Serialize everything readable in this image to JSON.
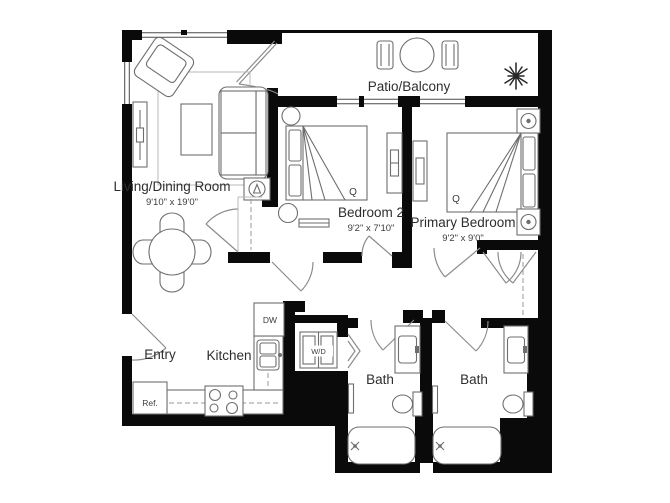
{
  "rooms": {
    "living_dining": {
      "name": "Living/Dining Room",
      "dims": "9'10\" x 19'0\""
    },
    "patio": {
      "name": "Patio/Balcony"
    },
    "bedroom2": {
      "name": "Bedroom 2",
      "dims": "9'2\" x 7'10\"",
      "bed_size": "Q"
    },
    "primary": {
      "name": "Primary Bedroom",
      "dims": "9'2\" x 9'0\"",
      "bed_size": "Q"
    },
    "entry": {
      "name": "Entry"
    },
    "kitchen": {
      "name": "Kitchen"
    },
    "bath1": {
      "name": "Bath"
    },
    "bath2": {
      "name": "Bath"
    }
  },
  "appliances": {
    "refrigerator": "Ref.",
    "dishwasher": "DW",
    "washer_dryer": "W/D"
  },
  "colors": {
    "wall": "#0a0a0a",
    "furniture_line": "#6e6e6e",
    "text": "#2e2e2e",
    "background": "#ffffff"
  }
}
